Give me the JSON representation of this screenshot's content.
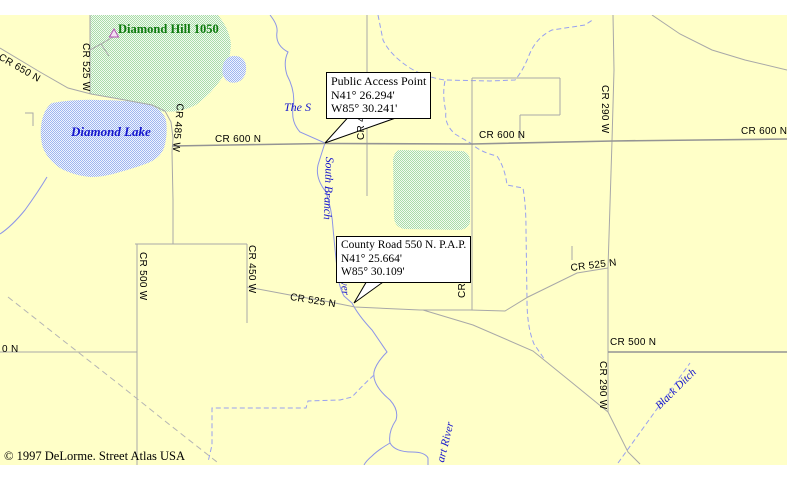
{
  "window": {
    "width": 789,
    "height": 479,
    "app": "Street Atlas USA map view"
  },
  "colors": {
    "page_margin": "#FFFFFF",
    "map_background": "#FFFFC8",
    "road_minor": "#A8A8A8",
    "road_major": "#949494",
    "water_line": "#8C94E8",
    "water_dashed": "#98A0F0",
    "lake_dither": "#9FB6EE",
    "green_dither": "#A9DCA9",
    "water_label": "#1414CD",
    "landmark_green": "#0E7A0E",
    "hill_marker": "#B34FB3"
  },
  "copyright": {
    "text": "© 1997 DeLorme.  Street Atlas USA"
  },
  "callouts": [
    {
      "title": "Public Access Point",
      "lat": "N41° 26.294'",
      "lon": "W85° 30.241'"
    },
    {
      "title": "County Road 550 N. P.A.P.",
      "lat": "N41° 25.664'",
      "lon": "W85° 30.109'"
    }
  ],
  "road_labels": [
    {
      "text": "CR 650 N",
      "x": 2,
      "y": 52,
      "rot": 30
    },
    {
      "text": "CR 525 W",
      "x": 91,
      "y": 43,
      "rot": 90
    },
    {
      "text": "CR 485 W",
      "x": 185,
      "y": 104,
      "rot": 95
    },
    {
      "text": "CR 600 N",
      "x": 215,
      "y": 134,
      "rot": 0
    },
    {
      "text": "CR 600 N",
      "x": 479,
      "y": 130,
      "rot": 0
    },
    {
      "text": "CR 600 N",
      "x": 741,
      "y": 126,
      "rot": 0
    },
    {
      "text": "CR 290 W",
      "x": 610,
      "y": 85,
      "rot": 90
    },
    {
      "text": "CR 290 W",
      "x": 608,
      "y": 361,
      "rot": 90
    },
    {
      "text": "CR 500 W",
      "x": 148,
      "y": 252,
      "rot": 90
    },
    {
      "text": "CR 450 W",
      "x": 257,
      "y": 245,
      "rot": 90
    },
    {
      "text": "CR 3",
      "x": 457,
      "y": 298,
      "rot": -90
    },
    {
      "text": "CR 4",
      "x": 356,
      "y": 140,
      "rot": -90
    },
    {
      "text": "CR 525 N",
      "x": 291,
      "y": 292,
      "rot": 9
    },
    {
      "text": "CR 525 N",
      "x": 570,
      "y": 263,
      "rot": -7
    },
    {
      "text": "0 N",
      "x": 2,
      "y": 344,
      "rot": 0
    },
    {
      "text": "CR 500 N",
      "x": 610,
      "y": 337,
      "rot": 0
    }
  ],
  "water_labels": [
    {
      "text": "Diamond Lake",
      "x": 71,
      "y": 125,
      "rot": 0,
      "size": 13,
      "bold": true
    },
    {
      "text": "The S",
      "x": 284,
      "y": 101,
      "rot": 0,
      "size": 12
    },
    {
      "text": "South Branch",
      "x": 334,
      "y": 157,
      "rot": 92,
      "size": 11.5
    },
    {
      "text": "River",
      "x": 348,
      "y": 270,
      "rot": 85,
      "size": 11.5
    },
    {
      "text": "art River",
      "x": 436,
      "y": 461,
      "rot": -76,
      "size": 11.5
    },
    {
      "text": "Black Ditch",
      "x": 654,
      "y": 404,
      "rot": -45,
      "size": 11
    }
  ],
  "landmarks": [
    {
      "text": "Diamond Hill 1050",
      "x": 118,
      "y": 23,
      "color": "#0E7A0E"
    }
  ]
}
